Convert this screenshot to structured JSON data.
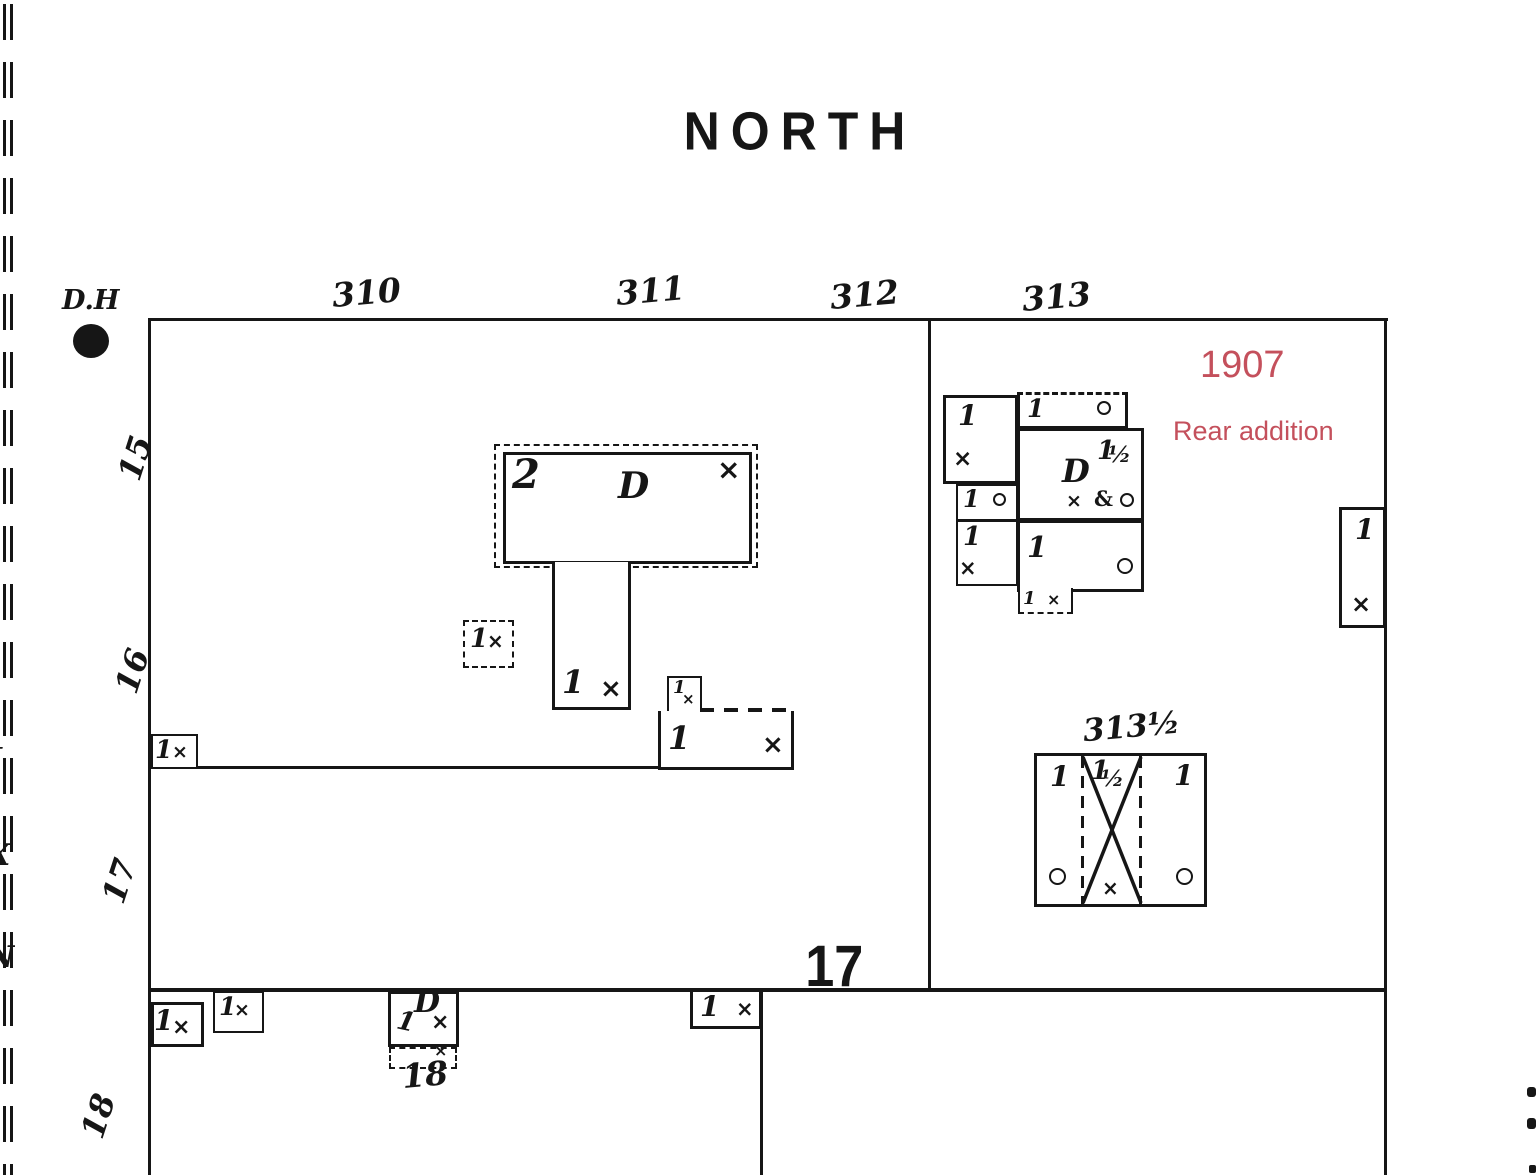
{
  "colors": {
    "ink": "#161616",
    "annotation_red": "#c4505c",
    "paper": "#ffffff"
  },
  "title": "NORTH",
  "header": {
    "corner_label": "D.H"
  },
  "red_annotation": {
    "year": "1907",
    "note": "Rear addition"
  },
  "streets": {
    "n310": "310",
    "n311": "311",
    "n312": "312",
    "n313": "313",
    "n313_half": "313½"
  },
  "lots": {
    "n15": "15",
    "n16": "16",
    "n17": "17",
    "n18": "18"
  },
  "block_number": "17",
  "south_house_number": "18",
  "marks": {
    "one": "1",
    "two": "2",
    "cross": "×",
    "dwelling_d": "D",
    "half": "½",
    "amp": "&"
  },
  "icons": {
    "dh_dot": "filled-circle",
    "window_vent": "open-circle",
    "boundary_dashes": "double-dashed-line"
  },
  "edge_fragments": {
    "f1": "J",
    "f2": "X",
    "f3": "N"
  }
}
